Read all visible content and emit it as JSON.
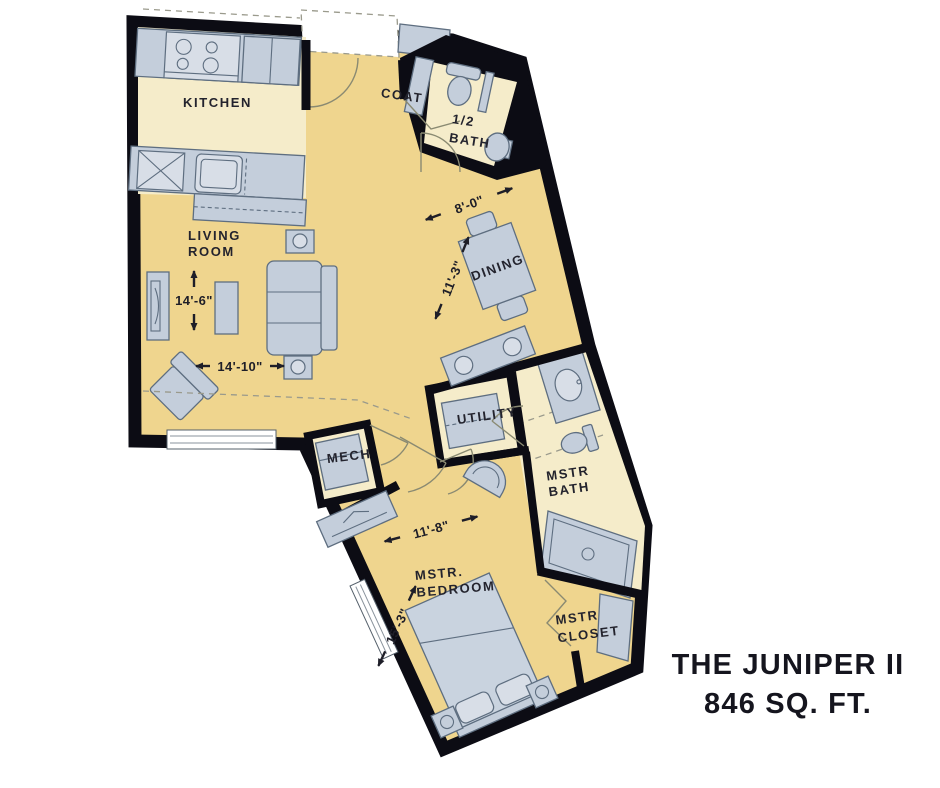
{
  "title": {
    "name": "THE JUNIPER II",
    "area": "846 SQ. FT."
  },
  "rooms": {
    "kitchen": {
      "label": "KITCHEN"
    },
    "living_room": {
      "label_line1": "LIVING",
      "label_line2": "ROOM",
      "depth": "14'-6\"",
      "width": "14'-10\""
    },
    "coat": {
      "label": "COAT"
    },
    "half_bath": {
      "label_line1": "1/2",
      "label_line2": "BATH"
    },
    "dining": {
      "label": "DINING",
      "width": "8'-0\"",
      "depth": "11'-3\""
    },
    "utility": {
      "label": "UTILITY"
    },
    "mech": {
      "label": "MECH"
    },
    "master_bath": {
      "label_line1": "MSTR",
      "label_line2": "BATH"
    },
    "master_bedroom": {
      "label_line1": "MSTR.",
      "label_line2": "BEDROOM",
      "width": "11'-8\"",
      "depth": "15'-3\""
    },
    "master_closet": {
      "label_line1": "MSTR",
      "label_line2": "CLOSET"
    }
  },
  "colors": {
    "floor_primary": "#EFD58E",
    "floor_secondary": "#F5ECCA",
    "fixtures": "#C4CEDB",
    "walls": "#0C0C14",
    "text": "#23232D"
  }
}
